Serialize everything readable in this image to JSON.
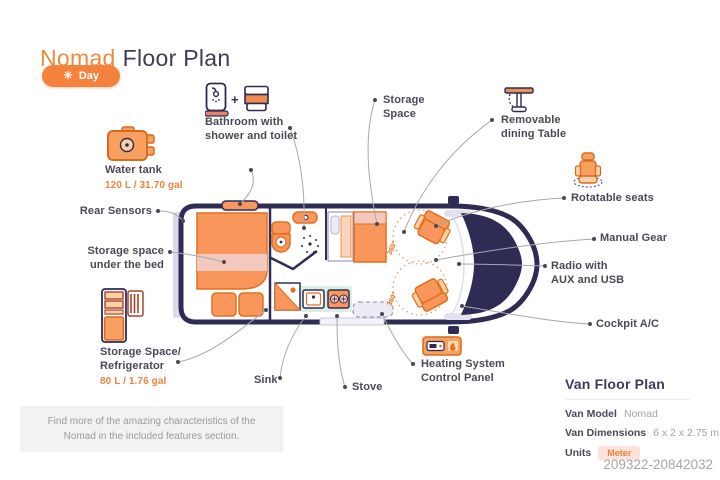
{
  "header": {
    "title_accent": "Nomad",
    "title_rest": "Floor Plan",
    "mode_label": "Day"
  },
  "callouts": {
    "bathroom": {
      "label": "Bathroom with shower and toilet"
    },
    "water_tank": {
      "label": "Water tank",
      "capacity": "120 L / 31.70 gal"
    },
    "rear_sensors": {
      "label": "Rear Sensors"
    },
    "storage_under_bed": {
      "label": "Storage space under the bed"
    },
    "storage_refrigerator": {
      "label": "Storage Space/ Refrigerator",
      "capacity": "80 L / 1.76 gal"
    },
    "sink": {
      "label": "Sink"
    },
    "stove": {
      "label": "Stove"
    },
    "heating": {
      "label": "Heating System Control Panel"
    },
    "storage_space": {
      "label": "Storage Space"
    },
    "dining_table": {
      "label": "Removable dining Table"
    },
    "rotatable_seats": {
      "label": "Rotatable seats"
    },
    "manual_gear": {
      "label": "Manual Gear"
    },
    "radio": {
      "label": "Radio with AUX and USB"
    },
    "cockpit_ac": {
      "label": "Cockpit A/C"
    }
  },
  "floorplan": {
    "seat_rotation_front": "360°",
    "seat_rotation_rear": "360°"
  },
  "info_panel": {
    "title": "Van Floor Plan",
    "rows": [
      {
        "label": "Van Model",
        "value": "Nomad"
      },
      {
        "label": "Van Dimensions",
        "value": "6 x 2 x 2.75 m"
      },
      {
        "label": "Units",
        "value": "Meter"
      }
    ]
  },
  "footer": {
    "note": "Find more of the amazing characteristics of the Nomad in the included features section.",
    "code": "209322-20842032"
  },
  "colors": {
    "accent": "#F0823C",
    "navy": "#2E2B55",
    "furniture_orange": "#F9965B",
    "furniture_pink": "#F4C9BD",
    "label_text": "#4A4857",
    "leader_gray": "#A8A8A8",
    "mint": "#DCEFE4",
    "lavender": "#EDEBF5"
  }
}
